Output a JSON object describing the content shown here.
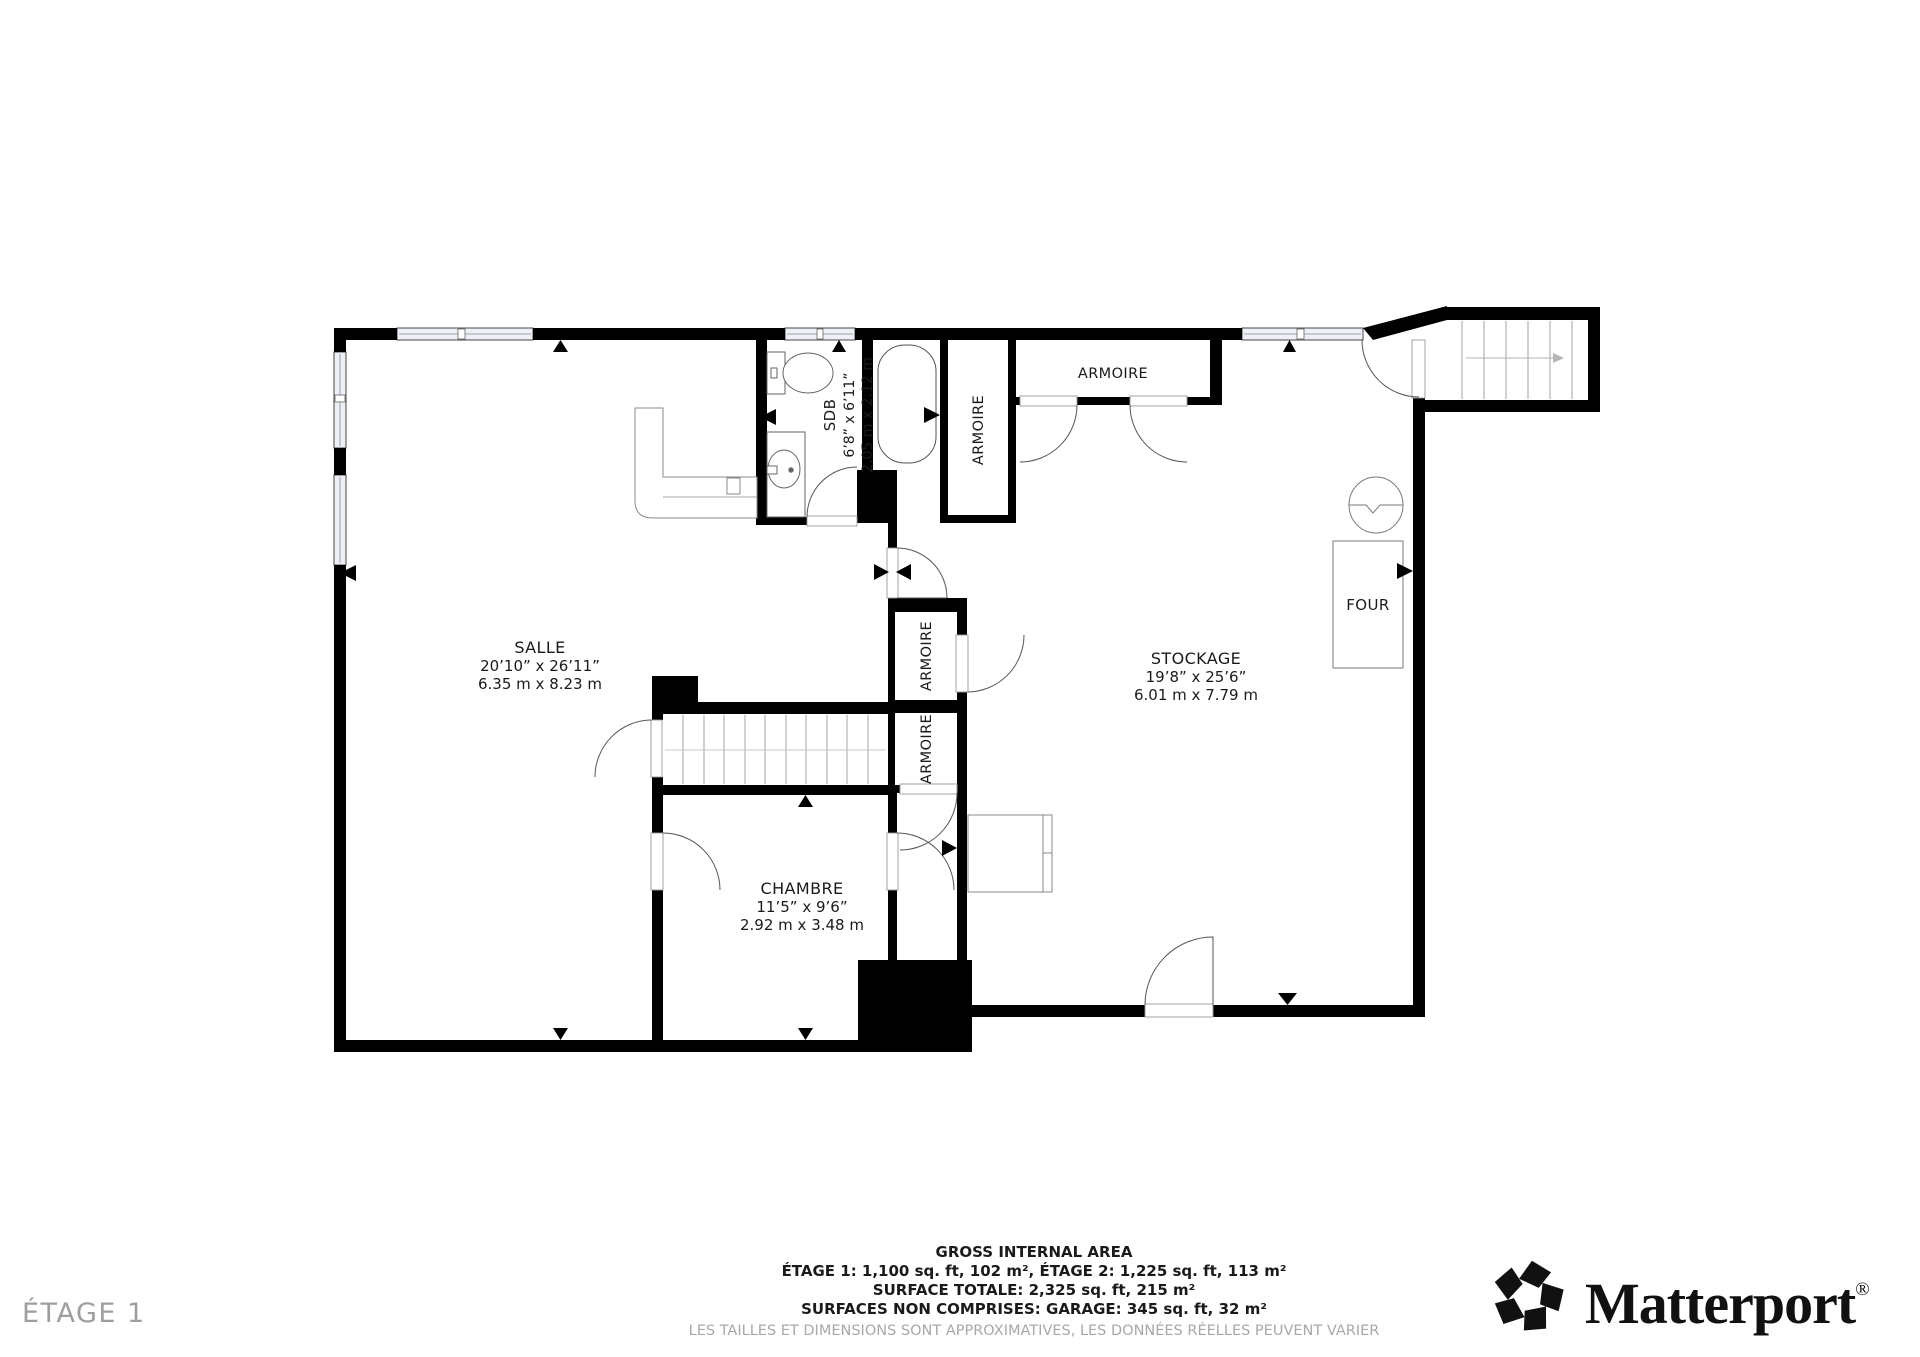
{
  "floor_label": "ÉTAGE 1",
  "rooms": {
    "salle": {
      "name": "SALLE",
      "dim_imperial": "20’10” x 26’11”",
      "dim_metric": "6.35 m x 8.23 m"
    },
    "sdb": {
      "name": "SDB",
      "dim_imperial": "6’8” x 6’11”",
      "dim_metric": "2.05 m x 2.12 m"
    },
    "stockage": {
      "name": "STOCKAGE",
      "dim_imperial": "19’8” x 25’6”",
      "dim_metric": "6.01 m x 7.79 m"
    },
    "chambre": {
      "name": "CHAMBRE",
      "dim_imperial": "11’5” x 9’6”",
      "dim_metric": "2.92 m x 3.48 m"
    }
  },
  "closets": {
    "labels": [
      "ARMOIRE",
      "ARMOIRE",
      "ARMOIRE",
      "ARMOIRE"
    ]
  },
  "appliances": {
    "oven": "FOUR"
  },
  "footer": {
    "title": "GROSS INTERNAL AREA",
    "line_floors": "ÉTAGE 1: 1,100 sq. ft, 102 m², ÉTAGE 2: 1,225 sq. ft, 113 m²",
    "line_total": "SURFACE TOTALE: 2,325 sq. ft, 215 m²",
    "line_excluded": "SURFACES NON COMPRISES: GARAGE: 345 sq. ft, 32 m²",
    "disclaimer": "LES TAILLES ET DIMENSIONS SONT APPROXIMATIVES, LES DONNÉES RÉELLES PEUVENT VARIER"
  },
  "brand": {
    "name": "Matterport",
    "registered": "®"
  },
  "colors": {
    "wall": "#000000",
    "window_fill": "#eef0f7",
    "fixture_stroke": "#777777",
    "muted_text": "#9e9e9e",
    "disclaimer_text": "#a8a8a8"
  }
}
